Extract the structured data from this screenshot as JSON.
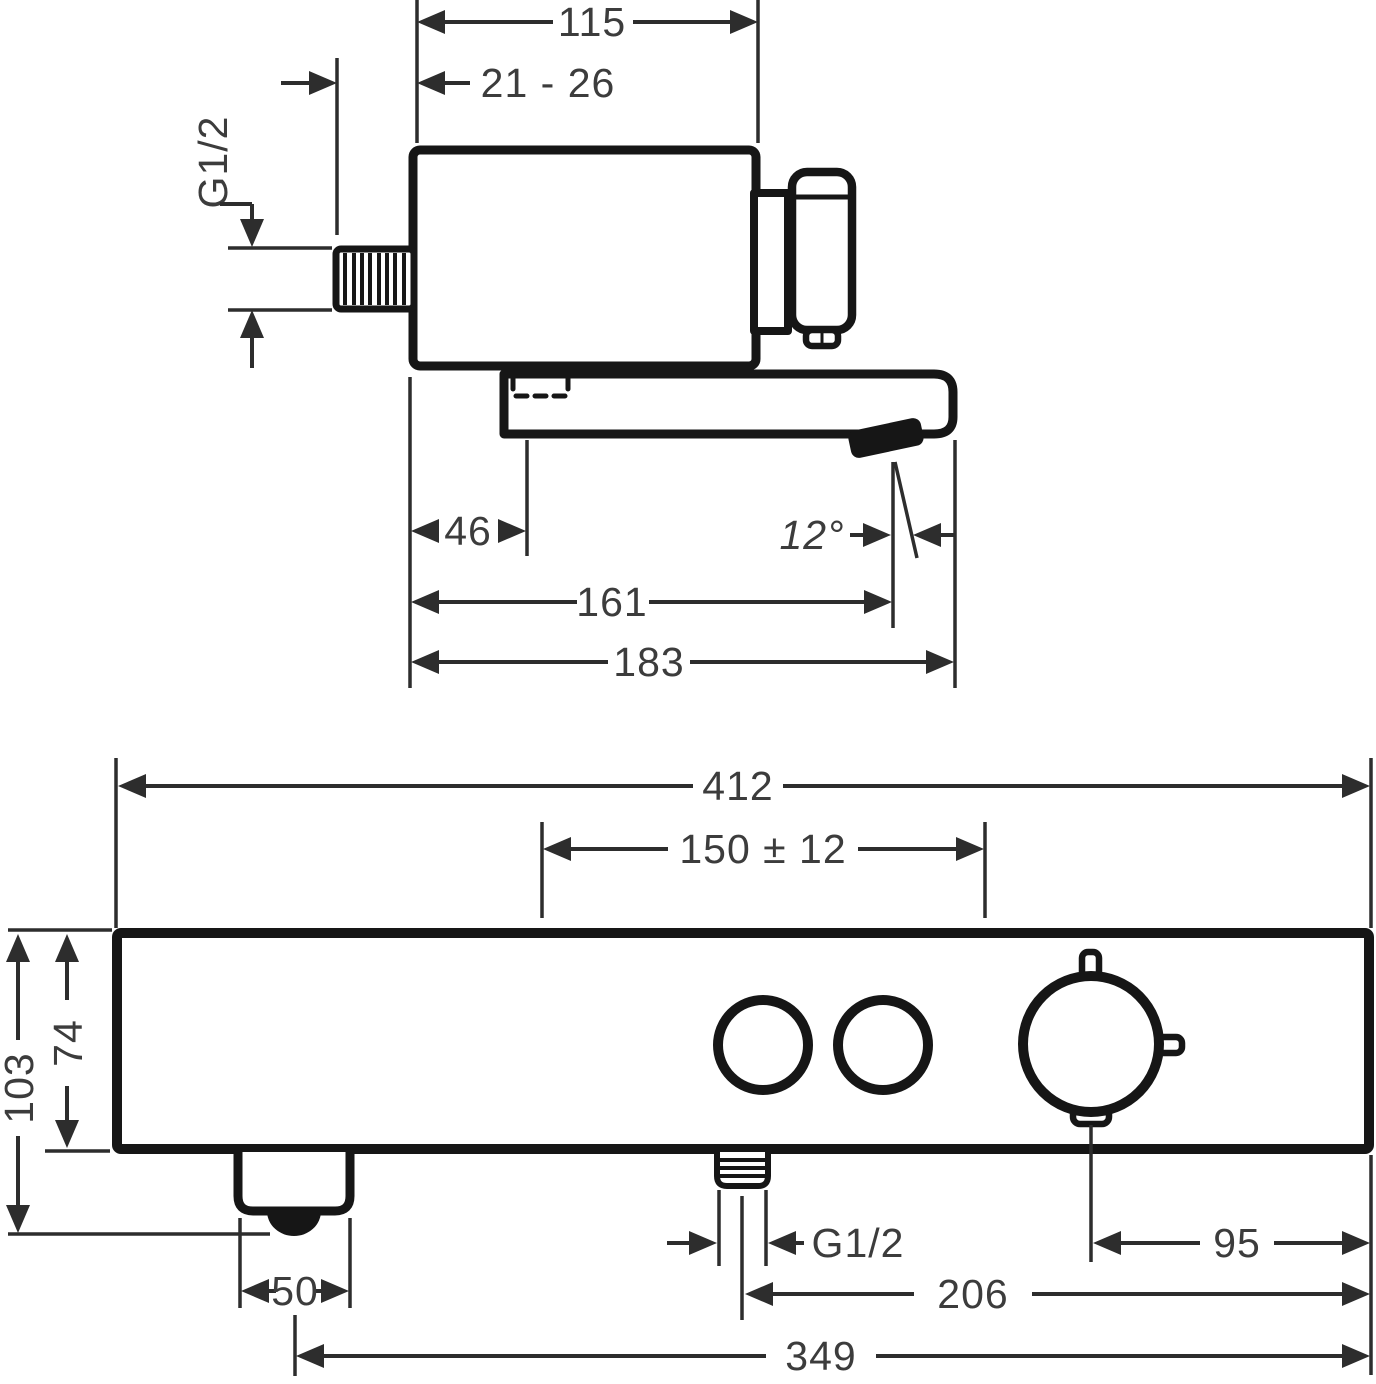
{
  "side_view": {
    "dim_body_width": "115",
    "dim_mount_depth": "21 - 26",
    "thread_label": "G1/2",
    "dim_spout_offset": "46",
    "dim_spray_angle": "12°",
    "dim_reach_to_spray": "161",
    "dim_reach_total": "183"
  },
  "front_view": {
    "dim_total_width": "412",
    "dim_connection_centers": "150 ± 12",
    "dim_height_total": "103",
    "dim_height_body": "74",
    "dim_spout_width": "50",
    "thread_label": "G1/2",
    "dim_knob_to_edge": "95",
    "dim_inlet_to_edge": "206",
    "dim_spout_to_edge": "349"
  },
  "colors": {
    "outline": "#161616",
    "dimension": "#2d2d2d",
    "text": "#3c3c3c",
    "background": "#ffffff"
  }
}
